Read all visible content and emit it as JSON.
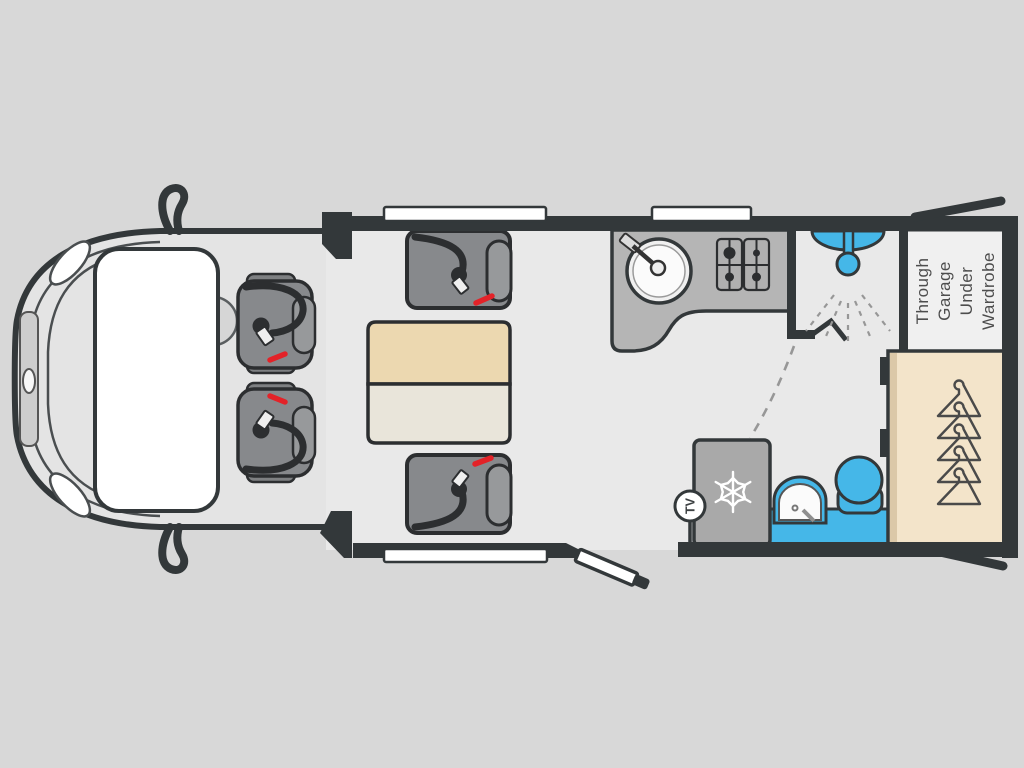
{
  "meta": {
    "type": "motorhome-floorplan-top-view"
  },
  "labels": {
    "garage_lines": [
      "Through",
      "Garage",
      "Under",
      "Wardrobe"
    ],
    "tv": "TV"
  },
  "colors": {
    "background": "#d8d8d8",
    "floor": "#e9e9e9",
    "cab": "#e4e4e4",
    "wall": "#33383a",
    "line": "#4a4e50",
    "window": "#ffffff",
    "counter": "#b5b5b5",
    "fridge": "#a9a9a9",
    "seat": "#87898c",
    "seat_trim": "#7e8082",
    "headrest": "#97999b",
    "belt": "#2c2e30",
    "belt_red": "#e32228",
    "accent_blue": "#45b7e8",
    "table_top": "#ecd8b0",
    "table_ext": "#e9e5da",
    "wardrobe": "#f3e4ca",
    "wardrobe_edge": "#dbc8a8",
    "label_box": "#f0f0f0",
    "label_text": "#4d4d4d",
    "dash": "#979797"
  },
  "icons": {
    "shower": "shower-head-with-spray",
    "fridge": "snowflake",
    "wardrobe": "clothes-hangers",
    "tv_point": "tv-circle",
    "hob": "four-burner-gas-hob",
    "sink": "round-sink-with-tap",
    "dinette": "seatbelt-buckles",
    "entry": "open-door",
    "garage": "rear-hatch-doors"
  }
}
